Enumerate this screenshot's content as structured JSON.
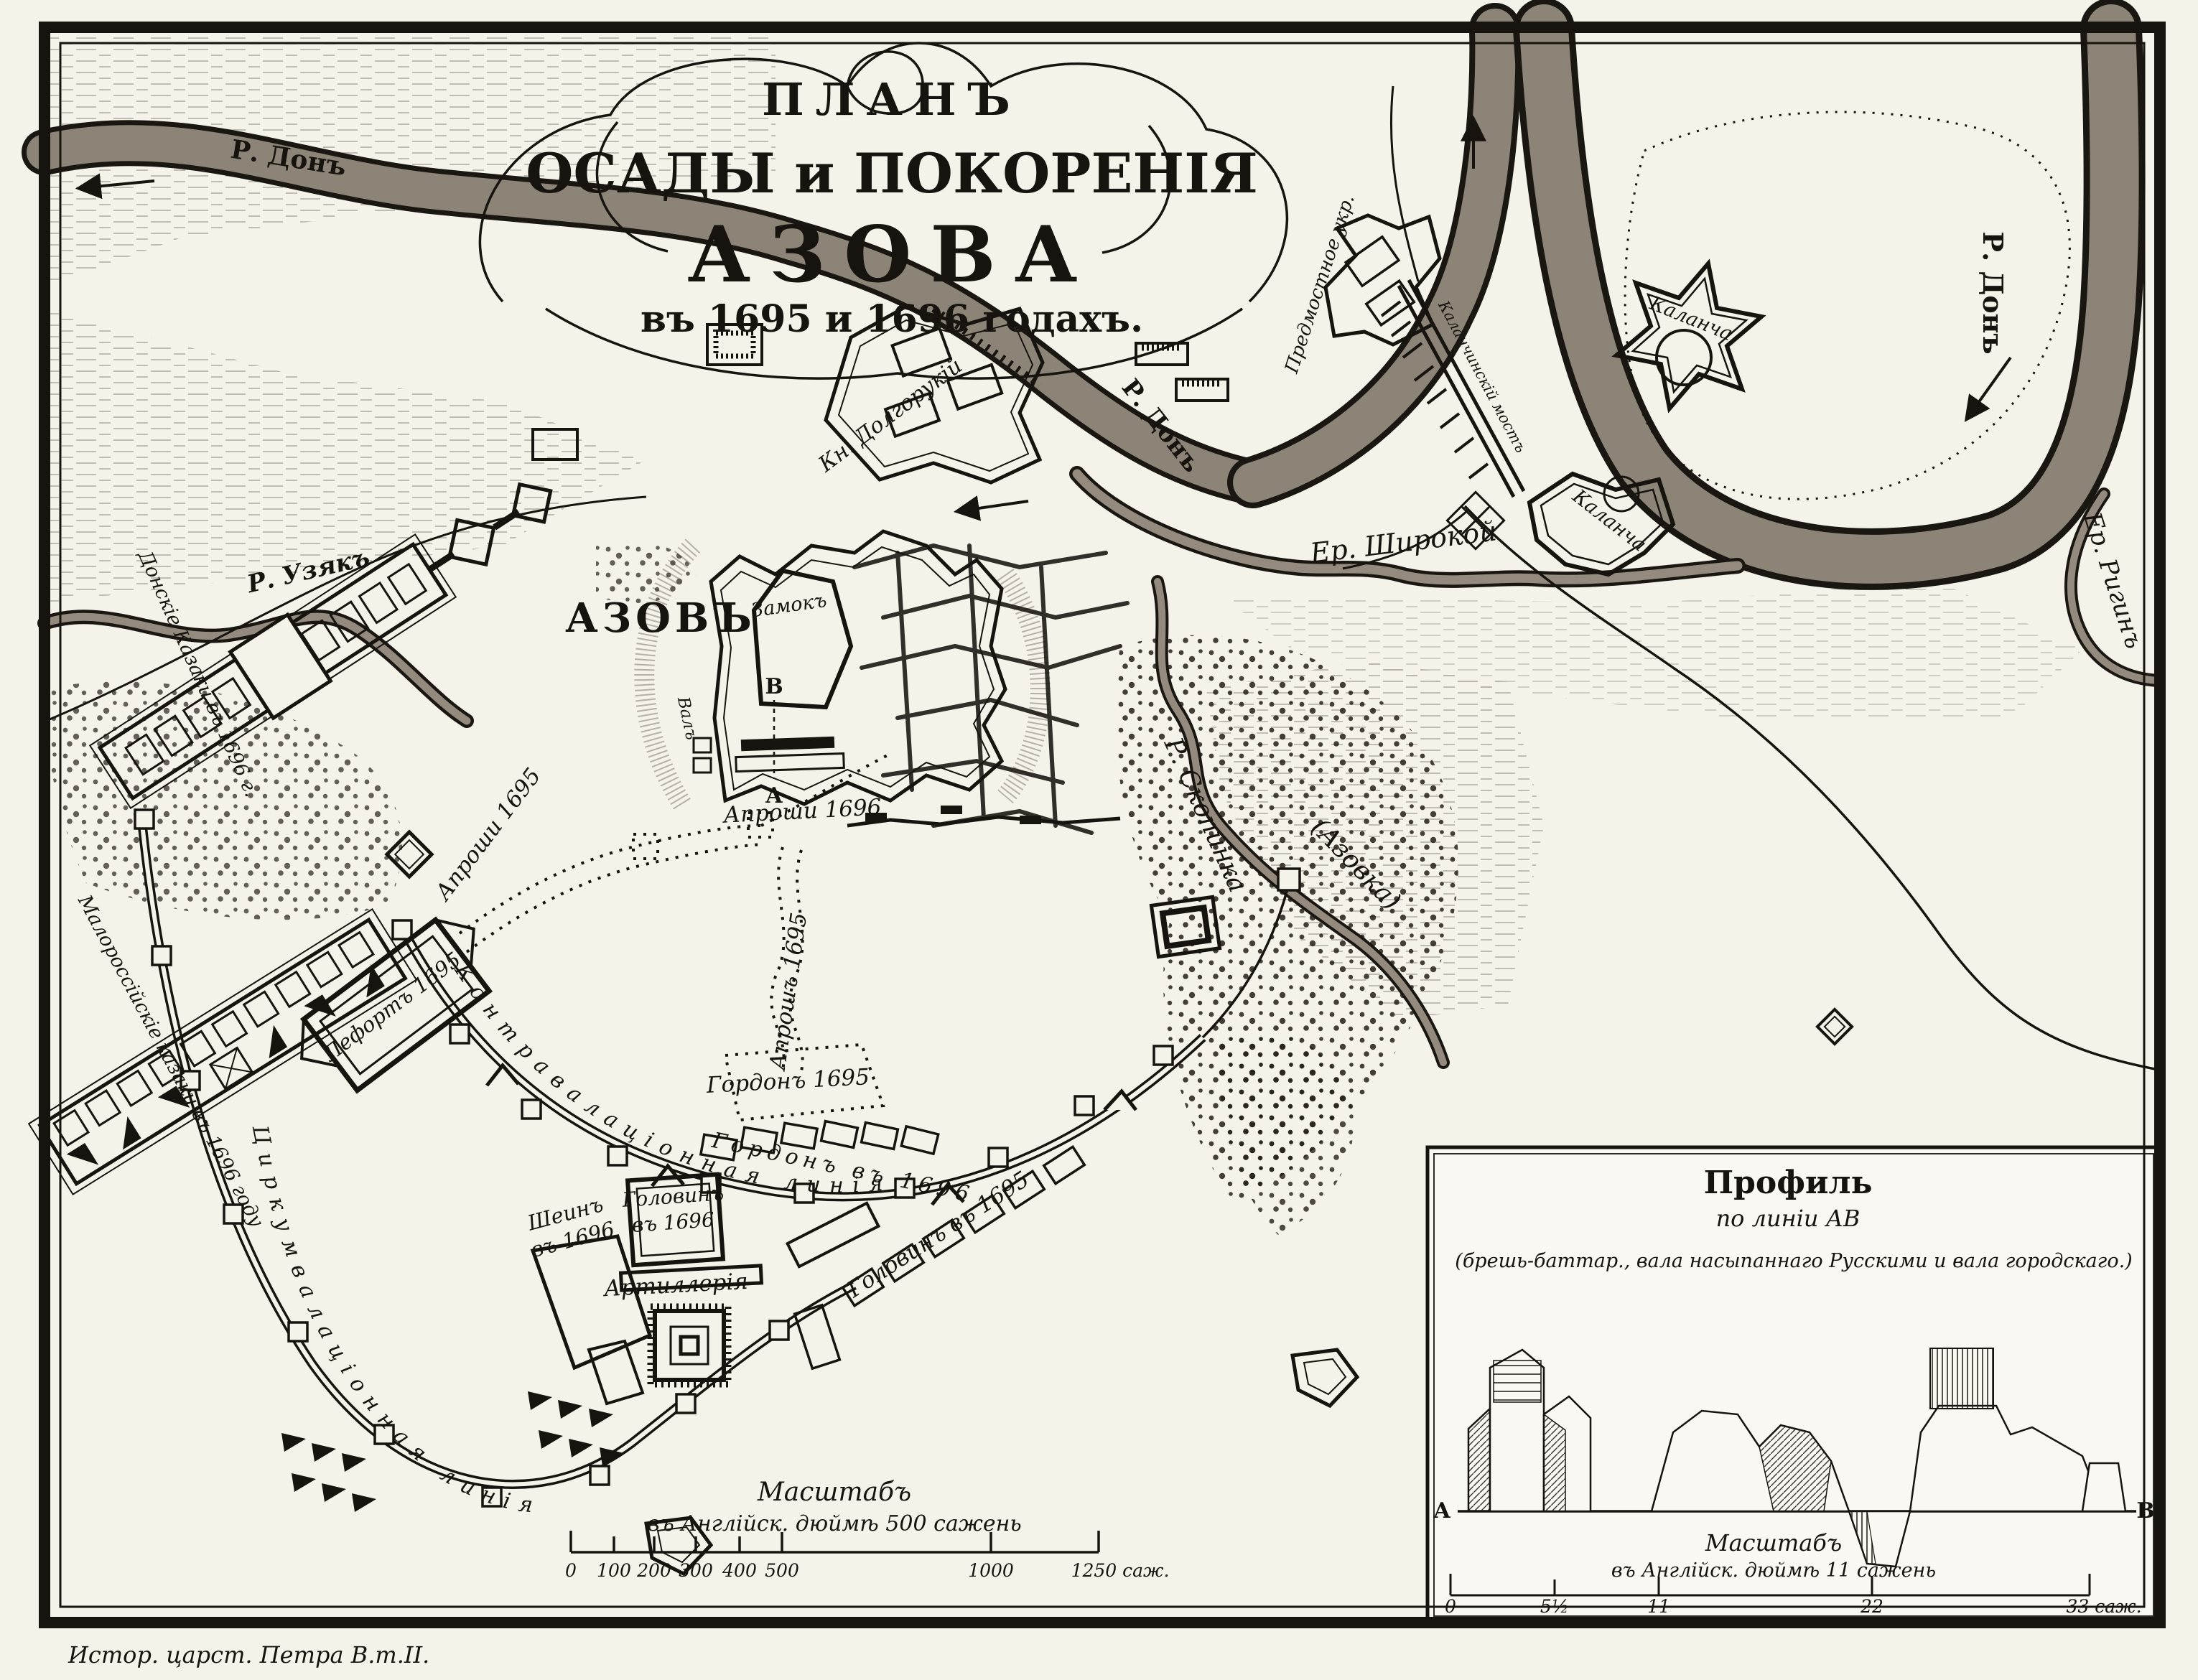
{
  "colors": {
    "paper": "#f5f2ea",
    "ink": "#17130e",
    "river": "#8d8478"
  },
  "title": {
    "line1": "ПЛАНЪ",
    "line2": "ОСАДЫ и ПОКОРЕНІЯ",
    "line3": "АЗОВА",
    "line4": "въ 1695 и 1696 годахъ."
  },
  "caption": "Истор. царст. Петра В.т.II.",
  "labels": {
    "don_left": "Р. Донъ",
    "don_mid": "Р. Донъ",
    "don_right": "Р. Донъ",
    "uzyak": "Р. Узякъ",
    "skopinka": "Р. Скопинка",
    "azovka": "(Азовка)",
    "shirokoy": "Ер. Широкой",
    "rigin": "Ер. Ригинъ",
    "azov": "АЗОВЪ",
    "zamok": "Замокъ",
    "val": "Валъ",
    "point_a": "А",
    "point_b": "В",
    "kalancha_star": "Каланча",
    "kalancha_fort": "Каланча",
    "predmostnoe": "Предмостное укр.",
    "bridge": "Каланчинскій мостъ",
    "dolgoruky": "Кн. Долгорукій",
    "don_cossacks": "Донскіе Казаки въ 1696 г.",
    "malorossian_cossacks": "Малороссійскіе казаки въ 1696 году",
    "lefort": "Лефортъ 1695",
    "aproshi_1695": "Апроши 1695",
    "aproshi_1696": "Апроши 1696",
    "aprosh_1695_v": "Апрошъ 1695",
    "gordon_1695": "Гордонъ 1695",
    "gordon_1696": "Гордонъ въ 1696",
    "golovin_1696_l1": "Головинъ",
    "golovin_1696_l2": "въ 1696",
    "golovin_1695": "Головинъ въ 1695",
    "shein_l1": "Шеинъ",
    "shein_l2": "въ 1696",
    "artillery": "Артиллерія",
    "contravallation": "Контравалаціонная линія",
    "circumvallation": "Циркумвалаціонная линія"
  },
  "map_scale": {
    "title": "Масштабъ",
    "subtitle": "въ Англійск. дюймѣ 500 сажень",
    "ticks": [
      "0",
      "100",
      "200",
      "300",
      "400",
      "500",
      "1000",
      "1250 саж."
    ]
  },
  "inset": {
    "title": "Профиль",
    "subtitle": "по линіи АВ",
    "note": "(брешь-баттар., вала насыпаннаго Русскими и вала городскаго.)",
    "scale_title": "Масштабъ",
    "scale_subtitle": "въ Англійск. дюймѣ 11 сажень",
    "ticks": [
      "0",
      "5½",
      "11",
      "22",
      "33 саж."
    ],
    "point_a": "A",
    "point_b": "B"
  }
}
